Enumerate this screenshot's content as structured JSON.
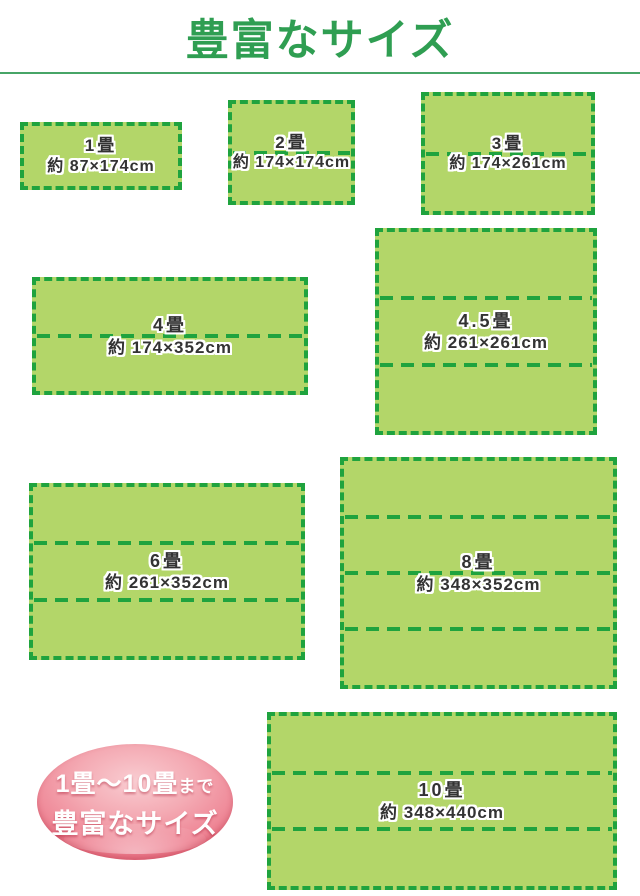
{
  "title": "豊富なサイズ",
  "mats": [
    {
      "name": "1畳",
      "size": "約 87×174cm"
    },
    {
      "name": "2畳",
      "size": "約 174×174cm"
    },
    {
      "name": "3畳",
      "size": "約 174×261cm"
    },
    {
      "name": "4畳",
      "size": "約 174×352cm"
    },
    {
      "name": "4.5畳",
      "size": "約 261×261cm"
    },
    {
      "name": "6畳",
      "size": "約 261×352cm"
    },
    {
      "name": "8畳",
      "size": "約 348×352cm"
    },
    {
      "name": "10畳",
      "size": "約 348×440cm"
    }
  ],
  "badge": {
    "range": "1畳〜10畳",
    "suffix": "まで",
    "caption": "豊富なサイズ"
  },
  "colors": {
    "mat_fill": "#b3d669",
    "mat_border": "#1fa33e",
    "title_green": "#2f9e52",
    "rule_green": "#47a567",
    "label_text": "#333333",
    "badge_pink_dark": "#d63b50",
    "badge_pink_light": "#f9ccd1",
    "badge_text": "#ffffff"
  }
}
